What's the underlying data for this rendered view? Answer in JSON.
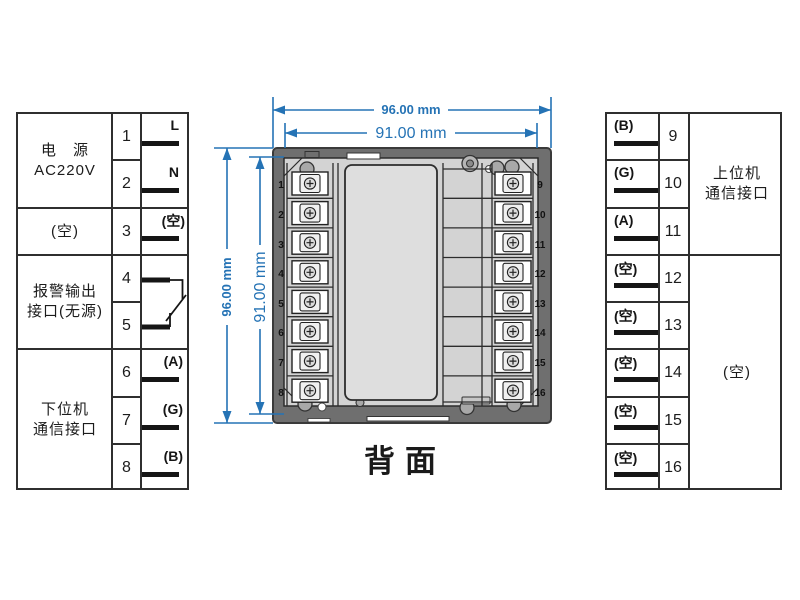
{
  "title": "背面",
  "dimensions": {
    "width_outer": "96.00 mm",
    "width_inner": "91.00 mm",
    "height_outer": "96.00 mm",
    "height_inner": "91.00 mm"
  },
  "left_table": {
    "groups": [
      {
        "label_lines": [
          "电　源",
          "AC220V"
        ],
        "rows": [
          {
            "num": "1",
            "tag": "L"
          },
          {
            "num": "2",
            "tag": "N"
          }
        ]
      },
      {
        "label_lines": [
          "(空)"
        ],
        "rows": [
          {
            "num": "3",
            "tag": "(空)"
          }
        ]
      },
      {
        "label_lines": [
          "报警输出",
          "接口(无源)"
        ],
        "rows": [
          {
            "num": "4",
            "tag": ""
          },
          {
            "num": "5",
            "tag": ""
          }
        ]
      },
      {
        "label_lines": [
          "下位机",
          "通信接口"
        ],
        "rows": [
          {
            "num": "6",
            "tag": "(A)"
          },
          {
            "num": "7",
            "tag": "(G)"
          },
          {
            "num": "8",
            "tag": "(B)"
          }
        ]
      }
    ]
  },
  "right_table": {
    "groups": [
      {
        "label_lines": [
          "上位机",
          "通信接口"
        ],
        "rows": [
          {
            "num": "9",
            "tag": "(B)"
          },
          {
            "num": "10",
            "tag": "(G)"
          },
          {
            "num": "11",
            "tag": "(A)"
          }
        ]
      },
      {
        "label_lines": [
          "(空)"
        ],
        "rows": [
          {
            "num": "12",
            "tag": "(空)"
          },
          {
            "num": "13",
            "tag": "(空)"
          },
          {
            "num": "14",
            "tag": "(空)"
          },
          {
            "num": "15",
            "tag": "(空)"
          },
          {
            "num": "16",
            "tag": "(空)"
          }
        ]
      }
    ]
  },
  "device": {
    "left_terminals": [
      "1",
      "2",
      "3",
      "4",
      "5",
      "6",
      "7",
      "8"
    ],
    "right_terminals": [
      "9",
      "10",
      "11",
      "12",
      "13",
      "14",
      "15",
      "16"
    ]
  },
  "colors": {
    "dimension_blue": "#2573b5",
    "line_dark": "#2f2f2f"
  }
}
